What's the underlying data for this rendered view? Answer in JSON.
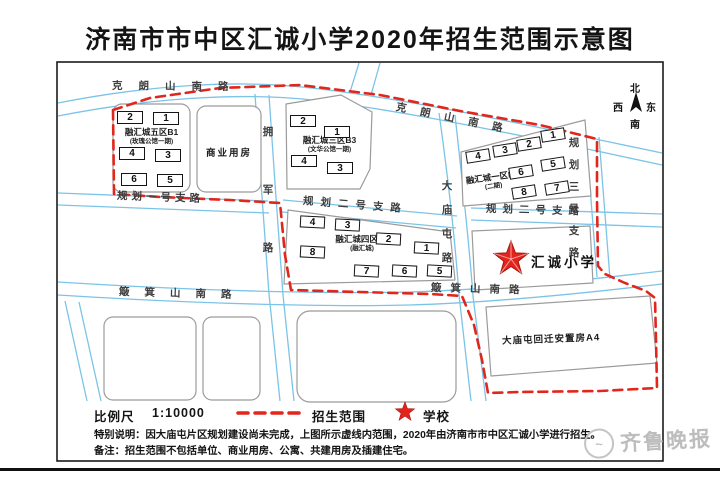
{
  "title": "济南市市中区汇诚小学2020年招生范围示意图",
  "compass": {
    "n": "北",
    "s": "南",
    "e": "东",
    "w": "西"
  },
  "colors": {
    "road_blue": "#7bc4e7",
    "boundary_red": "#e2261b",
    "star_red": "#e3241b",
    "parcel_border": "#9b9b9b"
  },
  "road_labels": [
    {
      "text": "克朗山南路",
      "x": 112,
      "y": 81,
      "rot": 0.5,
      "ls": 16
    },
    {
      "text": "克朗山南路",
      "x": 396,
      "y": 102,
      "rot": 11.5,
      "ls": 14
    },
    {
      "text": "拥军路",
      "x": 262,
      "y": 127,
      "vertical": true,
      "gap": 47
    },
    {
      "text": "大庙屯路",
      "x": 441,
      "y": 181,
      "vertical": true,
      "gap": 13
    },
    {
      "text": "规划一号支路",
      "x": 117,
      "y": 191,
      "rot": 2,
      "ls": 4
    },
    {
      "text": "规划二号支路",
      "x": 303,
      "y": 196,
      "rot": 4.5,
      "ls": 7
    },
    {
      "text": "规划二号支路",
      "x": 486,
      "y": 204,
      "rot": 1.5,
      "ls": 6
    },
    {
      "text": "规划三号支路",
      "x": 568,
      "y": 138,
      "vertical": true,
      "gap": 11
    },
    {
      "text": "簸箕山南路",
      "x": 119,
      "y": 287,
      "rot": 1.5,
      "ls": 15
    },
    {
      "text": "簸箕山南路",
      "x": 431,
      "y": 283,
      "rot": 1.5,
      "ls": 9
    }
  ],
  "blocks": {
    "b1": {
      "name": "融汇城五区B1",
      "sub": "(玫瑰公馆一期)"
    },
    "commercial": {
      "label": "商业用房"
    },
    "b3": {
      "name": "融汇城三区B3",
      "sub": "(文华公馆一期)"
    },
    "b5": {
      "name": "融汇城一区B5",
      "sub": "(二期)"
    },
    "b7": {
      "name": "融汇城四区B7",
      "sub": "(融汇城)"
    },
    "school": {
      "label": "汇诚小学"
    },
    "a4": {
      "label": "大庙屯回迁安置房A4"
    }
  },
  "buildings": [
    {
      "n": "2",
      "x": 117,
      "y": 111,
      "r": 0,
      "w": 26,
      "h": 13
    },
    {
      "n": "1",
      "x": 153,
      "y": 112,
      "r": 0,
      "w": 26,
      "h": 13
    },
    {
      "n": "4",
      "x": 119,
      "y": 147,
      "r": 0,
      "w": 26,
      "h": 13
    },
    {
      "n": "3",
      "x": 155,
      "y": 149,
      "r": 0,
      "w": 26,
      "h": 13
    },
    {
      "n": "6",
      "x": 121,
      "y": 173,
      "r": 0,
      "w": 26,
      "h": 13
    },
    {
      "n": "5",
      "x": 157,
      "y": 174,
      "r": 0,
      "w": 26,
      "h": 13
    },
    {
      "n": "2",
      "x": 290,
      "y": 115,
      "r": 0,
      "w": 26,
      "h": 12
    },
    {
      "n": "1",
      "x": 324,
      "y": 126,
      "r": 0,
      "w": 26,
      "h": 12
    },
    {
      "n": "4",
      "x": 291,
      "y": 155,
      "r": 0,
      "w": 26,
      "h": 12
    },
    {
      "n": "3",
      "x": 327,
      "y": 162,
      "r": 0,
      "w": 26,
      "h": 12
    },
    {
      "n": "1",
      "x": 541,
      "y": 129,
      "r": -9,
      "w": 24,
      "h": 12
    },
    {
      "n": "2",
      "x": 517,
      "y": 138,
      "r": -9,
      "w": 24,
      "h": 12
    },
    {
      "n": "3",
      "x": 493,
      "y": 144,
      "r": -9,
      "w": 24,
      "h": 12
    },
    {
      "n": "4",
      "x": 466,
      "y": 150,
      "r": -9,
      "w": 24,
      "h": 12
    },
    {
      "n": "5",
      "x": 541,
      "y": 158,
      "r": -9,
      "w": 24,
      "h": 12
    },
    {
      "n": "6",
      "x": 509,
      "y": 166,
      "r": -9,
      "w": 24,
      "h": 12
    },
    {
      "n": "7",
      "x": 545,
      "y": 182,
      "r": -9,
      "w": 24,
      "h": 12
    },
    {
      "n": "8",
      "x": 512,
      "y": 186,
      "r": -9,
      "w": 24,
      "h": 12
    },
    {
      "n": "4",
      "x": 300,
      "y": 216,
      "r": 3,
      "w": 25,
      "h": 12
    },
    {
      "n": "3",
      "x": 335,
      "y": 219,
      "r": 3,
      "w": 25,
      "h": 12
    },
    {
      "n": "2",
      "x": 376,
      "y": 233,
      "r": 3,
      "w": 25,
      "h": 12
    },
    {
      "n": "1",
      "x": 414,
      "y": 242,
      "r": 3,
      "w": 25,
      "h": 12
    },
    {
      "n": "8",
      "x": 300,
      "y": 246,
      "r": 3,
      "w": 25,
      "h": 12
    },
    {
      "n": "7",
      "x": 354,
      "y": 265,
      "r": 3,
      "w": 25,
      "h": 12
    },
    {
      "n": "6",
      "x": 392,
      "y": 265,
      "r": 3,
      "w": 25,
      "h": 12
    },
    {
      "n": "5",
      "x": 427,
      "y": 265,
      "r": 3,
      "w": 25,
      "h": 12
    }
  ],
  "legend": {
    "scale_label": "比例尺",
    "scale_value": "1:10000",
    "range_label": "招生范围",
    "school_label": "学校"
  },
  "notes": {
    "special": "特别说明：因大庙屯片区规划建设尚未完成，上图所示虚线内范围，2020年由济南市市中区汇诚小学进行招生。",
    "remark": "备注：招生范围不包括单位、商业用房、公寓、共建用房及插建住宅。"
  },
  "watermark": {
    "label": "齐鲁晚报"
  }
}
